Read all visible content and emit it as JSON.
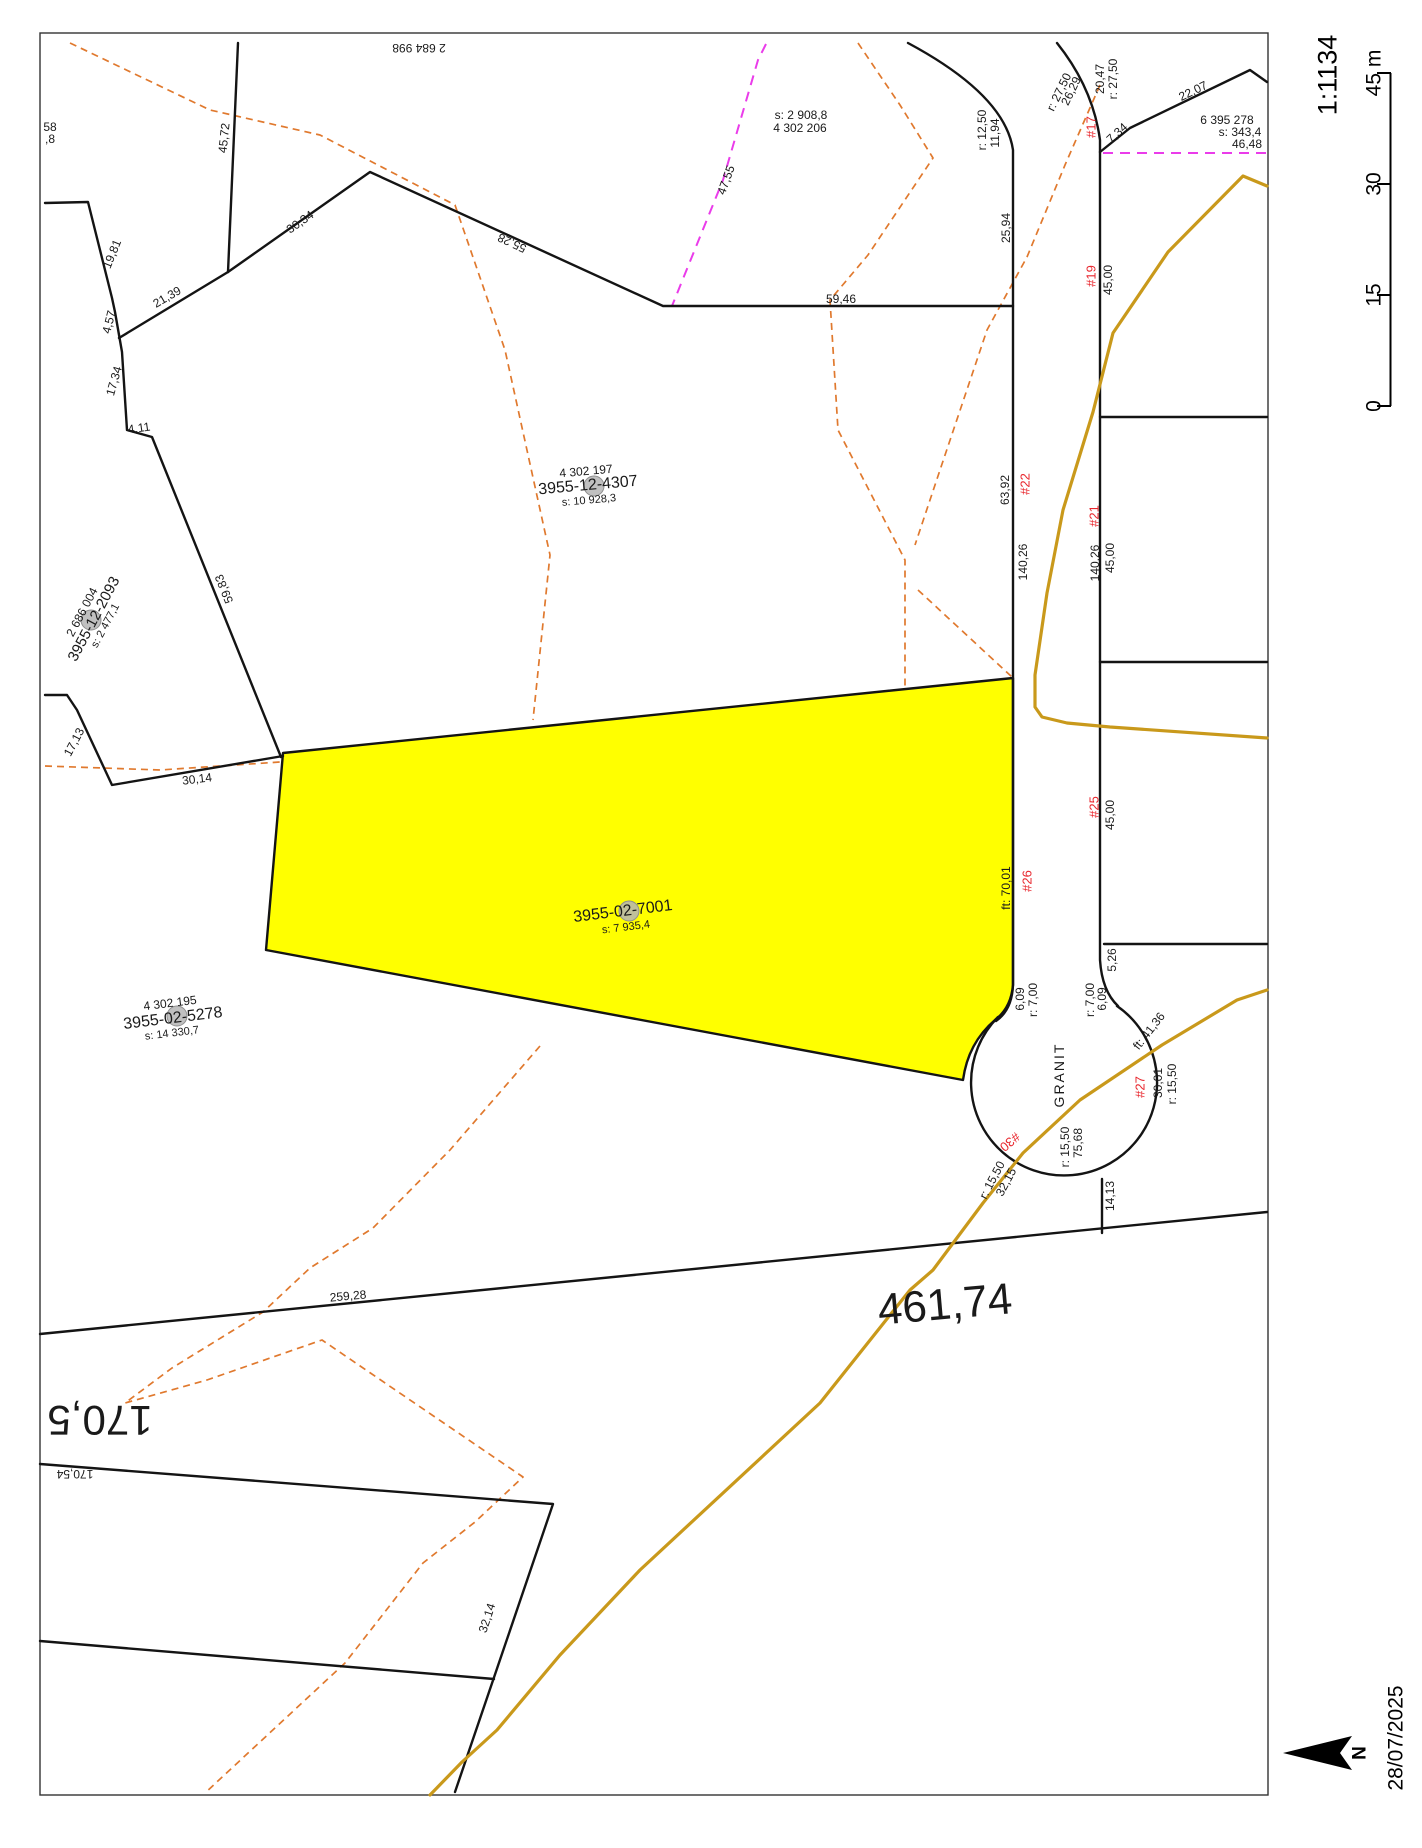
{
  "page": {
    "date": "28/07/2025",
    "north_label": "N"
  },
  "scale": {
    "ratio_label": "1:1134",
    "bar_x": 1390,
    "ticks": [
      {
        "label": "0",
        "y": 406
      },
      {
        "label": "15",
        "y": 295
      },
      {
        "label": "30",
        "y": 184
      },
      {
        "label": "45 m",
        "y": 73
      }
    ]
  },
  "map": {
    "colors": {
      "text": "#1a1a1a",
      "lot_number": "#e8262d",
      "highlight_fill": "#ffff00",
      "boundary": "#141414",
      "stream": "#c9991b",
      "contour": "#e0792e",
      "proposed": "#ea3cea",
      "marker": "#b5b5b5"
    },
    "street_name": "GRANIT",
    "highlight_parcel": {
      "id": "3955-02-7001",
      "area": "s: 7 935,4"
    },
    "gray_markers": [
      {
        "x": 594,
        "y": 486
      },
      {
        "x": 91,
        "y": 620
      },
      {
        "x": 629,
        "y": 911
      },
      {
        "x": 177,
        "y": 1016
      }
    ],
    "labels": [
      {
        "name": "parcel-id",
        "text": "2 684 998",
        "x": 419,
        "y": 48,
        "rot": 180
      },
      {
        "name": "dimension",
        "text": "58",
        "x": 50,
        "y": 127
      },
      {
        "name": "dimension",
        "text": ",8",
        "x": 50,
        "y": 139
      },
      {
        "name": "dimension",
        "text": "45,72",
        "x": 224,
        "y": 138,
        "rot": -84
      },
      {
        "name": "dimension",
        "text": "19,81",
        "x": 112,
        "y": 254,
        "rot": -68
      },
      {
        "name": "dimension",
        "text": "30,34",
        "x": 300,
        "y": 222,
        "rot": -35
      },
      {
        "name": "dimension",
        "text": "21,39",
        "x": 167,
        "y": 297,
        "rot": -30
      },
      {
        "name": "dimension",
        "text": "4,57",
        "x": 109,
        "y": 322,
        "rot": -76
      },
      {
        "name": "dimension",
        "text": "17,34",
        "x": 114,
        "y": 381,
        "rot": -74
      },
      {
        "name": "dimension",
        "text": "55,28",
        "x": 512,
        "y": 243,
        "rot": 205
      },
      {
        "name": "dimension",
        "text": "4,11",
        "x": 139,
        "y": 428,
        "rot": -8
      },
      {
        "name": "dimension",
        "text": "59,83",
        "x": 224,
        "y": 589,
        "rot": -112
      },
      {
        "name": "dimension",
        "text": "17,13",
        "x": 74,
        "y": 742,
        "rot": -62
      },
      {
        "name": "dimension",
        "text": "30,14",
        "x": 197,
        "y": 779,
        "rot": -7
      },
      {
        "name": "parcel-area",
        "text": "s: 2 908,8",
        "x": 801,
        "y": 115
      },
      {
        "name": "parcel-id",
        "text": "4 302 206",
        "x": 800,
        "y": 128
      },
      {
        "name": "dimension",
        "text": "47,55",
        "x": 726,
        "y": 180,
        "rot": -70
      },
      {
        "name": "dimension",
        "text": "59,46",
        "x": 841,
        "y": 299
      },
      {
        "name": "dimension",
        "text": "r: 12,50",
        "x": 982,
        "y": 130,
        "rot": -90
      },
      {
        "name": "dimension",
        "text": "11,94",
        "x": 995,
        "y": 133,
        "rot": -90
      },
      {
        "name": "dimension",
        "text": "25,94",
        "x": 1006,
        "y": 228,
        "rot": -90
      },
      {
        "name": "dimension",
        "text": "r: 27,50",
        "x": 1059,
        "y": 92,
        "rot": -64
      },
      {
        "name": "dimension",
        "text": "26,29",
        "x": 1071,
        "y": 91,
        "rot": -64
      },
      {
        "name": "lot-number",
        "text": "#17",
        "x": 1091,
        "y": 127,
        "rot": -90,
        "size": 13,
        "color": "red"
      },
      {
        "name": "dimension",
        "text": "20,47",
        "x": 1100,
        "y": 79,
        "rot": -90
      },
      {
        "name": "dimension",
        "text": "r: 27,50",
        "x": 1113,
        "y": 79,
        "rot": -90
      },
      {
        "name": "dimension",
        "text": "7,34",
        "x": 1117,
        "y": 133,
        "rot": -42
      },
      {
        "name": "dimension",
        "text": "22,07",
        "x": 1193,
        "y": 91,
        "rot": -26
      },
      {
        "name": "parcel-id",
        "text": "6 395 278",
        "x": 1227,
        "y": 120
      },
      {
        "name": "parcel-area",
        "text": "s: 343,4",
        "x": 1240,
        "y": 132
      },
      {
        "name": "dimension",
        "text": "46,48",
        "x": 1247,
        "y": 144
      },
      {
        "name": "lot-number",
        "text": "#19",
        "x": 1091,
        "y": 276,
        "rot": -90,
        "size": 13,
        "color": "red"
      },
      {
        "name": "dimension",
        "text": "45,00",
        "x": 1108,
        "y": 280,
        "rot": -90
      },
      {
        "name": "dimension",
        "text": "63,92",
        "x": 1005,
        "y": 490,
        "rot": -90
      },
      {
        "name": "lot-number",
        "text": "#22",
        "x": 1025,
        "y": 484,
        "rot": -90,
        "size": 13,
        "color": "red"
      },
      {
        "name": "dimension",
        "text": "140,26",
        "x": 1023,
        "y": 562,
        "rot": -90
      },
      {
        "name": "lot-number",
        "text": "#21",
        "x": 1094,
        "y": 516,
        "rot": -90,
        "size": 13,
        "color": "red"
      },
      {
        "name": "dimension",
        "text": "140,26",
        "x": 1095,
        "y": 563,
        "rot": -90
      },
      {
        "name": "dimension",
        "text": "45,00",
        "x": 1110,
        "y": 558,
        "rot": -90
      },
      {
        "name": "lot-number",
        "text": "#25",
        "x": 1094,
        "y": 807,
        "rot": -90,
        "size": 13,
        "color": "red"
      },
      {
        "name": "dimension",
        "text": "45,00",
        "x": 1110,
        "y": 815,
        "rot": -90
      },
      {
        "name": "lot-number",
        "text": "#26",
        "x": 1027,
        "y": 881,
        "rot": -90,
        "size": 13,
        "color": "red"
      },
      {
        "name": "dimension",
        "text": "ft: 70,01",
        "x": 1006,
        "y": 888,
        "rot": -90
      },
      {
        "name": "dimension",
        "text": "6,09",
        "x": 1020,
        "y": 999,
        "rot": -90
      },
      {
        "name": "dimension",
        "text": "r: 7,00",
        "x": 1033,
        "y": 1000,
        "rot": -90
      },
      {
        "name": "dimension",
        "text": "r: 7,00",
        "x": 1090,
        "y": 1000,
        "rot": -90
      },
      {
        "name": "dimension",
        "text": "6,09",
        "x": 1102,
        "y": 999,
        "rot": -90
      },
      {
        "name": "dimension",
        "text": "5,26",
        "x": 1112,
        "y": 960,
        "rot": -90
      },
      {
        "name": "street-name",
        "text": "GRANIT",
        "x": 1059,
        "y": 1075,
        "rot": -90,
        "size": 14,
        "spacing": 2
      },
      {
        "name": "lot-number",
        "text": "#30",
        "x": 1010,
        "y": 1142,
        "rot": 140,
        "size": 13,
        "color": "red"
      },
      {
        "name": "dimension",
        "text": "r: 15,50",
        "x": 1065,
        "y": 1147,
        "rot": -90
      },
      {
        "name": "dimension",
        "text": "75,68",
        "x": 1078,
        "y": 1143,
        "rot": -90
      },
      {
        "name": "dimension",
        "text": "r: 15,50",
        "x": 992,
        "y": 1180,
        "rot": -62
      },
      {
        "name": "dimension",
        "text": "32,15",
        "x": 1006,
        "y": 1182,
        "rot": -62
      },
      {
        "name": "dimension",
        "text": "14,13",
        "x": 1110,
        "y": 1196,
        "rot": -90
      },
      {
        "name": "dimension",
        "text": "ft: 41,36",
        "x": 1149,
        "y": 1031,
        "rot": -52
      },
      {
        "name": "lot-number",
        "text": "#27",
        "x": 1140,
        "y": 1087,
        "rot": -90,
        "size": 13,
        "color": "red"
      },
      {
        "name": "dimension",
        "text": "30,01",
        "x": 1158,
        "y": 1083,
        "rot": -90
      },
      {
        "name": "dimension",
        "text": "r: 15,50",
        "x": 1172,
        "y": 1084,
        "rot": -90
      },
      {
        "name": "parcel-id",
        "text": "4 302 197",
        "x": 586,
        "y": 471,
        "rot": -5
      },
      {
        "name": "parcel-id",
        "text": "3955-12-4307",
        "x": 588,
        "y": 486,
        "rot": -5,
        "size": 16
      },
      {
        "name": "parcel-area",
        "text": "s: 10 928,3",
        "x": 589,
        "y": 501,
        "rot": -5,
        "size": 11
      },
      {
        "name": "parcel-id",
        "text": "2 686 004",
        "x": 82,
        "y": 612,
        "rot": -62
      },
      {
        "name": "parcel-id",
        "text": "3955-12-2093",
        "x": 94,
        "y": 619,
        "rot": -62,
        "size": 15
      },
      {
        "name": "parcel-area",
        "text": "s: 2 477,1",
        "x": 106,
        "y": 626,
        "rot": -62,
        "size": 11
      },
      {
        "name": "parcel-id",
        "text": "4 302 195",
        "x": 170,
        "y": 1003,
        "rot": -7
      },
      {
        "name": "parcel-id",
        "text": "3955-02-5278",
        "x": 173,
        "y": 1019,
        "rot": -7,
        "size": 16
      },
      {
        "name": "parcel-area",
        "text": "s: 14 330,7",
        "x": 172,
        "y": 1034,
        "rot": -7,
        "size": 11
      },
      {
        "name": "highlight-parcel-id",
        "text": "3955-02-7001",
        "x": 623,
        "y": 912,
        "rot": -7,
        "size": 16
      },
      {
        "name": "highlight-parcel-area",
        "text": "s: 7 935,4",
        "x": 626,
        "y": 928,
        "rot": -7,
        "size": 11
      },
      {
        "name": "dimension",
        "text": "259,28",
        "x": 348,
        "y": 1296,
        "rot": -5
      },
      {
        "name": "big-dimension",
        "text": "461,74",
        "x": 945,
        "y": 1305,
        "rot": -5,
        "size": 44
      },
      {
        "name": "big-dimension",
        "text": "170,5",
        "x": 100,
        "y": 1420,
        "rot": 180,
        "size": 42
      },
      {
        "name": "dimension",
        "text": "170,54",
        "x": 75,
        "y": 1474,
        "rot": 180
      },
      {
        "name": "dimension",
        "text": "32,14",
        "x": 487,
        "y": 1618,
        "rot": -72
      }
    ]
  }
}
